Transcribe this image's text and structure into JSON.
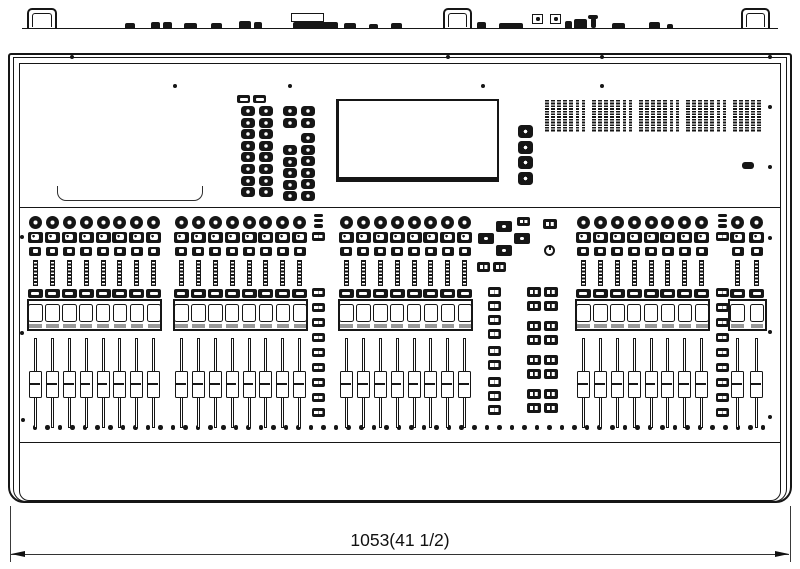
{
  "diagram": {
    "title": "Digital mixing console - front view dimensional drawing",
    "dimension_label": "1053(41 1/2)"
  },
  "console": {
    "rear_handles": 3,
    "channel_sections": [
      {
        "id": "bay-1",
        "channels": 8
      },
      {
        "id": "bay-2",
        "channels": 8
      },
      {
        "id": "bay-3",
        "channels": 8
      },
      {
        "id": "bay-4",
        "channels": 8
      },
      {
        "id": "master-bay",
        "channels": 2
      }
    ],
    "per_channel_controls": [
      "encoder-knob",
      "select-button",
      "cue-button",
      "level-meter",
      "on-button",
      "name-display",
      "fader"
    ],
    "meter_bridge_groups": [
      7,
      7,
      7,
      7,
      5
    ],
    "selected_channel_encoder_columns": [
      8,
      8,
      7,
      8
    ],
    "center_encoder_column_knobs": 4,
    "icons": {
      "power": "standby-power-symbol",
      "dimension_arrows": "filled-arrowheads"
    }
  },
  "colors": {
    "line": "#161616",
    "panel": "#ffffff",
    "display_bar": "#999999"
  }
}
